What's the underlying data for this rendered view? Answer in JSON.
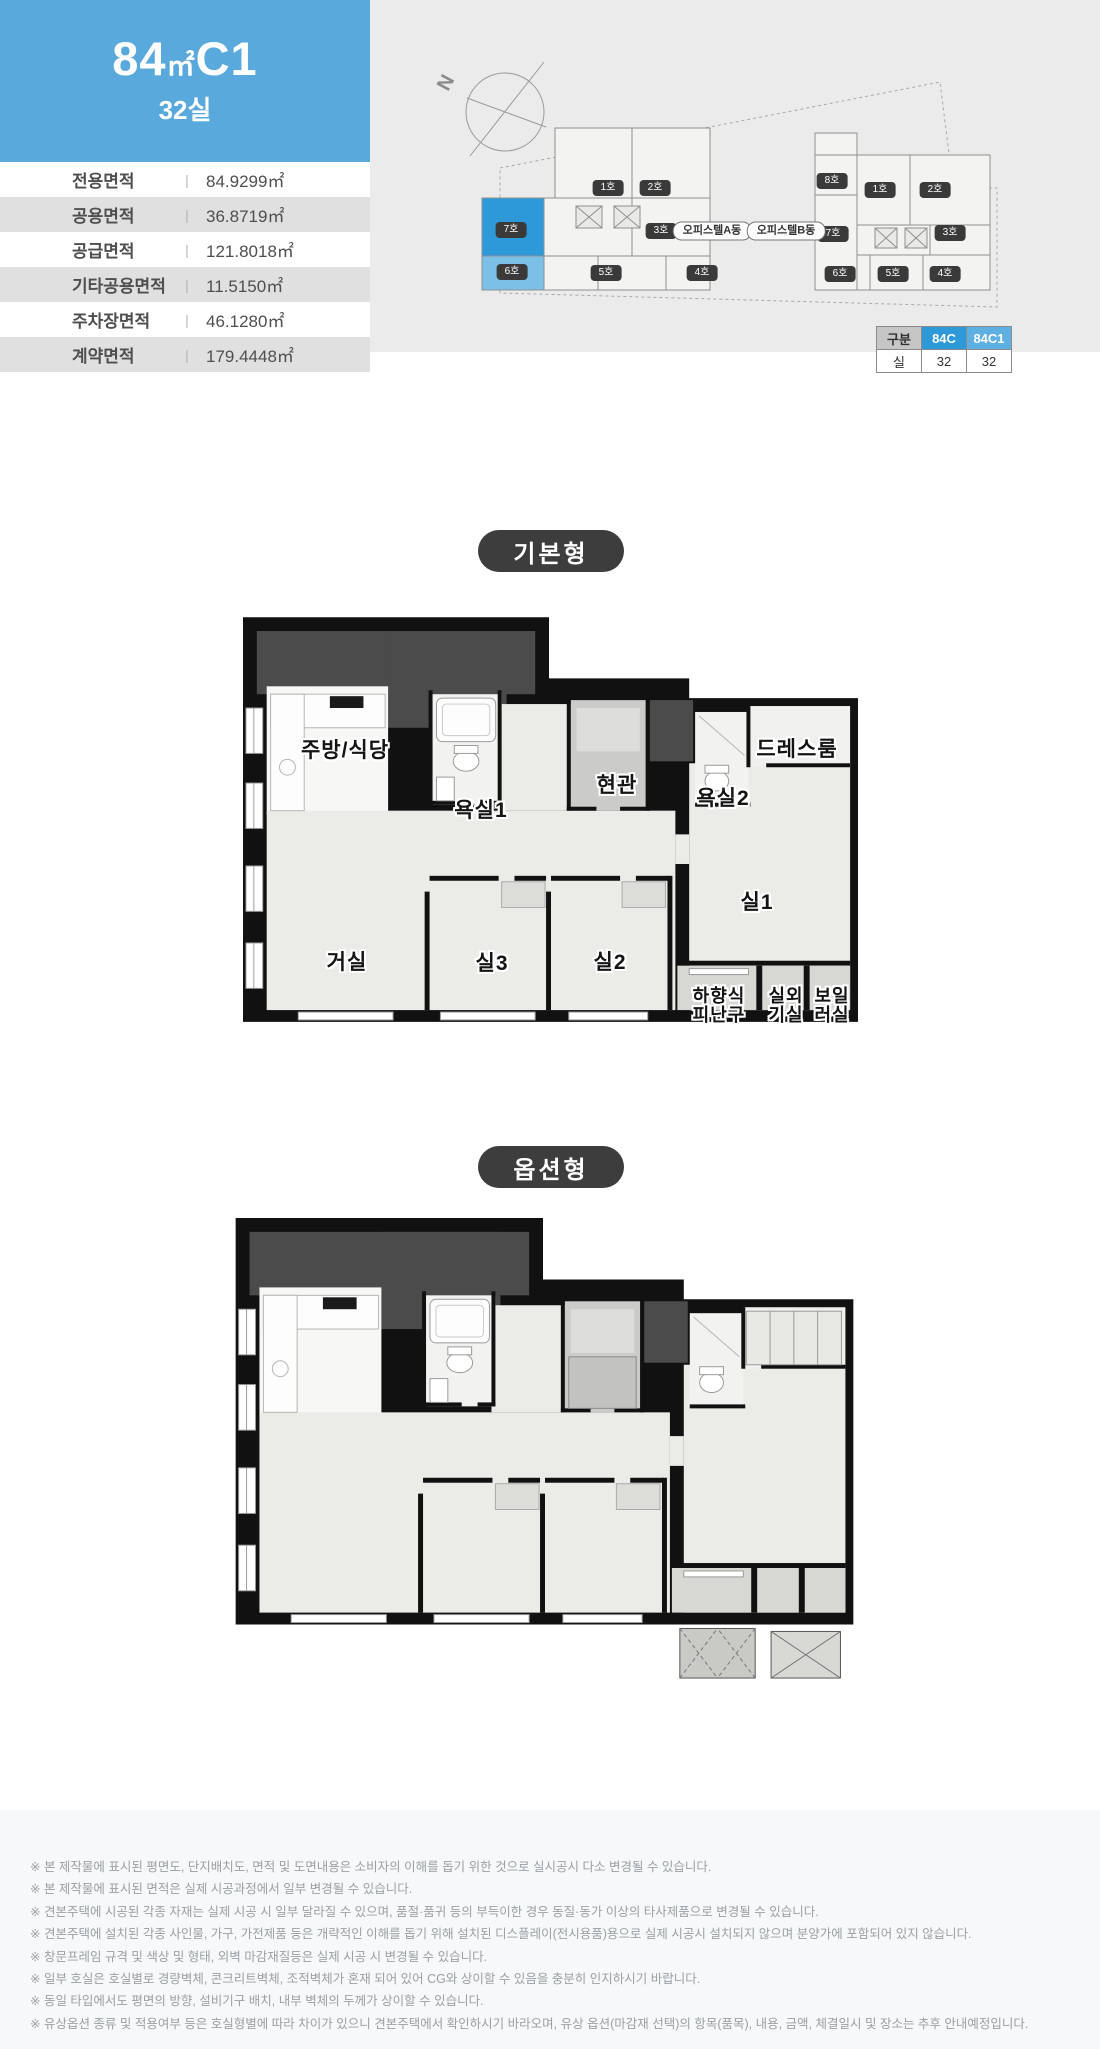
{
  "header": {
    "area": "84",
    "unit": "㎡",
    "type": "C1",
    "rooms": "32실"
  },
  "spec_table": {
    "separator": "|",
    "rows": [
      {
        "label": "전용면적",
        "value": "84.9299㎡"
      },
      {
        "label": "공용면적",
        "value": "36.8719㎡"
      },
      {
        "label": "공급면적",
        "value": "121.8018㎡"
      },
      {
        "label": "기타공용면적",
        "value": "11.5150㎡"
      },
      {
        "label": "주차장면적",
        "value": "46.1280㎡"
      },
      {
        "label": "계약면적",
        "value": "179.4448㎡"
      }
    ]
  },
  "site": {
    "north_label": "N",
    "building_a": {
      "name": "오피스텔A동",
      "units": [
        "1호",
        "2호",
        "7호",
        "3호",
        "6호",
        "5호",
        "4호"
      ]
    },
    "building_b": {
      "name": "오피스텔B동",
      "units": [
        "8호",
        "1호",
        "2호",
        "7호",
        "3호",
        "6호",
        "5호",
        "4호"
      ]
    },
    "type_table": {
      "header": [
        "구분",
        "84C",
        "84C1"
      ],
      "row": [
        "실",
        "32",
        "32"
      ]
    }
  },
  "sections": {
    "basic": "기본형",
    "option": "옵션형"
  },
  "floorplan": {
    "rooms": [
      "주방/식당",
      "욕실1",
      "현관",
      "욕실2",
      "드레스룸",
      "거실",
      "실3",
      "실2",
      "실1",
      "하향식\n피난구",
      "실외\n기실",
      "보일\n러실"
    ]
  },
  "disclaimer": {
    "lines": [
      "※ 본 제작물에 표시된 평면도, 단지배치도, 면적 및 도면내용은 소비자의 이해를 돕기 위한 것으로 실시공시 다소 변경될 수 있습니다.",
      "※ 본 제작물에 표시된 면적은 실제 시공과정에서 일부 변경될 수 있습니다.",
      "※ 견본주택에 시공된 각종 자재는 실제 시공 시 일부 달라질 수 있으며, 품절·품귀 등의 부득이한 경우 동질·동가 이상의 타사제품으로 변경될 수 있습니다.",
      "※ 견본주택에 설치된 각종 사인물, 가구, 가전제품 등은 개략적인 이해를 돕기 위해 설치된 디스플레이(전시용품)용으로 실제 시공시 설치되지 않으며 분양가에 포함되어 있지 않습니다.",
      "※ 창문프레임 규격 및 색상 및 형태, 외벽 마감재질등은 실제 시공 시 변경될 수 있습니다.",
      "※ 일부 호실은 호실별로 경량벽체, 콘크리트벽체, 조적벽체가 혼재 되어 있어 CG와 상이할 수 있음을 충분히 인지하시기 바랍니다.",
      "※ 동일 타입에서도 평면의 방향, 설비기구 배치, 내부 벽체의 두께가 상이할 수 있습니다.",
      "※ 유상옵션 종류 및 적용여부 등은 호실형별에 따라 차이가 있으니 견본주택에서 확인하시기 바라오며, 유상 옵션(마감재 선택)의 항목(품목), 내용, 금액, 체결일시 및 장소는 추후 안내예정입니다."
    ]
  },
  "colors": {
    "header_blue": "#5aa9dc",
    "highlight_dark": "#2e99d8",
    "highlight_light": "#7cc0e8",
    "badge_dark": "#3d3d3d",
    "site_panel_gray": "#ebebeb",
    "table_row_gray": "#e0e0e0",
    "disclaimer_bg": "#f6f8f9"
  }
}
